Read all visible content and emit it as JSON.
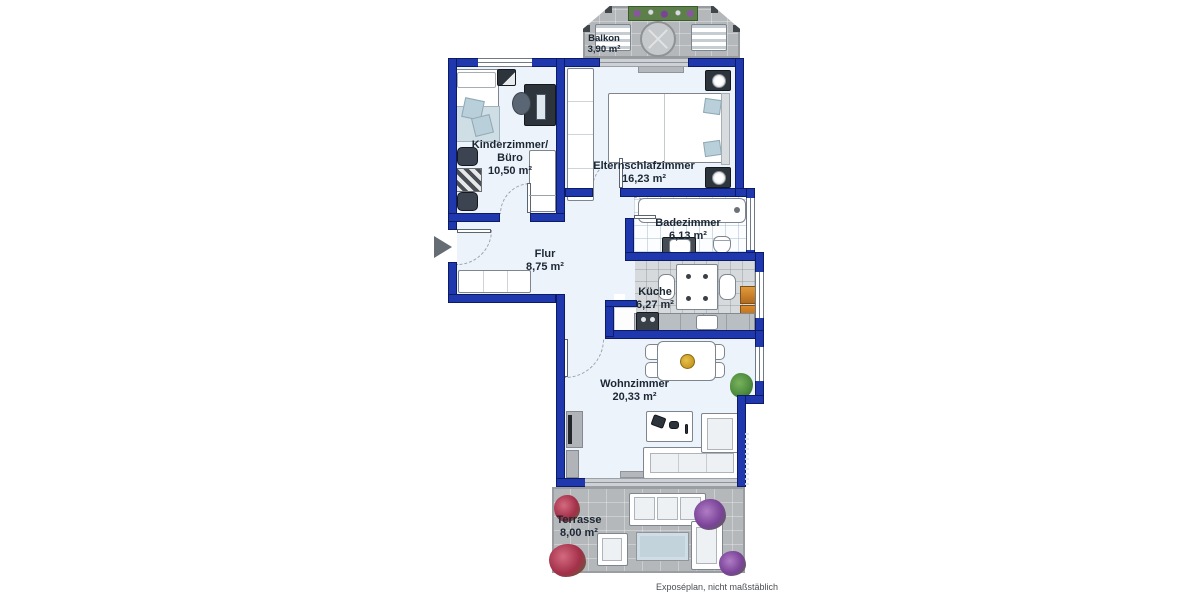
{
  "plan": {
    "rooms": [
      {
        "key": "balkon",
        "line1": "Balkon",
        "area": "3,90 m²"
      },
      {
        "key": "kinderzimmer-buero",
        "line1": "Kinderzimmer/",
        "line2": "Büro",
        "area": "10,50 m²"
      },
      {
        "key": "elternschlafzimmer",
        "line1": "Elternschlafzimmer",
        "area": "16,23 m²"
      },
      {
        "key": "badezimmer",
        "line1": "Badezimmer",
        "area": "6,13 m²"
      },
      {
        "key": "flur",
        "line1": "Flur",
        "area": "8,75 m²"
      },
      {
        "key": "kueche",
        "line1": "Küche",
        "area": "6,27 m²"
      },
      {
        "key": "wohnzimmer",
        "line1": "Wohnzimmer",
        "area": "20,33 m²"
      },
      {
        "key": "terrasse",
        "line1": "Terrasse",
        "area": "8,00 m²"
      }
    ],
    "footer_note": "Exposéplan, nicht maßstäblich",
    "colors": {
      "wall": "#2038ae",
      "floor": "#edf3fb",
      "paving": "#b5b8ba"
    }
  }
}
